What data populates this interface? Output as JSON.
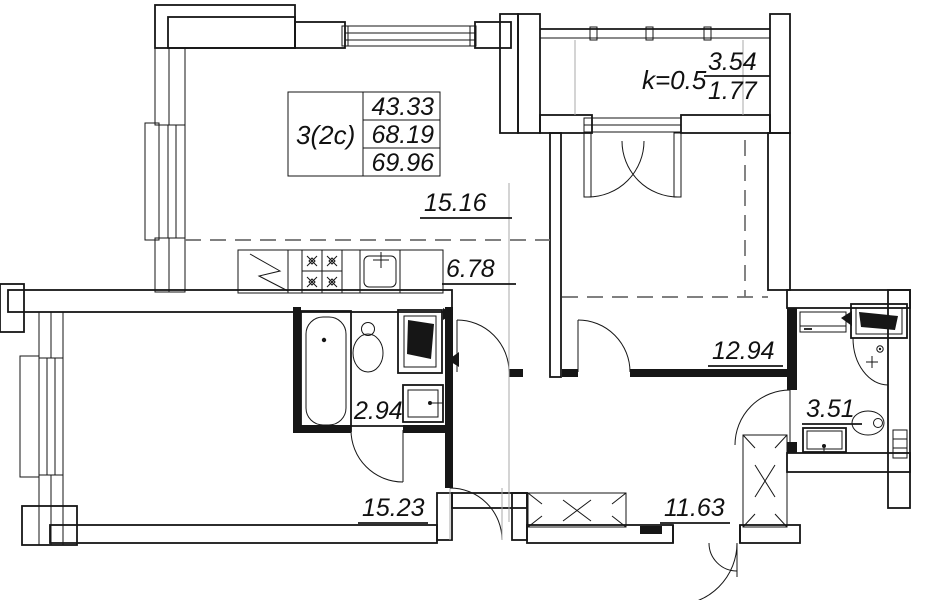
{
  "plan": {
    "apartment_card": {
      "type_label": "3(2c)",
      "values": [
        "43.33",
        "68.19",
        "69.96"
      ]
    },
    "balcony": {
      "coefficient": "k=0.5",
      "area_full": "3.54",
      "area_reduced": "1.77"
    },
    "rooms": [
      {
        "id": "living-zone",
        "area": "15.16"
      },
      {
        "id": "kitchen-zone",
        "area": "6.78"
      },
      {
        "id": "bedroom",
        "area": "12.94"
      },
      {
        "id": "bathroom-combined",
        "area": "2.94"
      },
      {
        "id": "bathroom",
        "area": "3.51"
      },
      {
        "id": "room-lower",
        "area": "15.23"
      },
      {
        "id": "hallway",
        "area": "11.63"
      }
    ],
    "colors": {
      "ink": "#161616",
      "paper": "#ffffff",
      "guide": "#a8a8a8"
    }
  }
}
